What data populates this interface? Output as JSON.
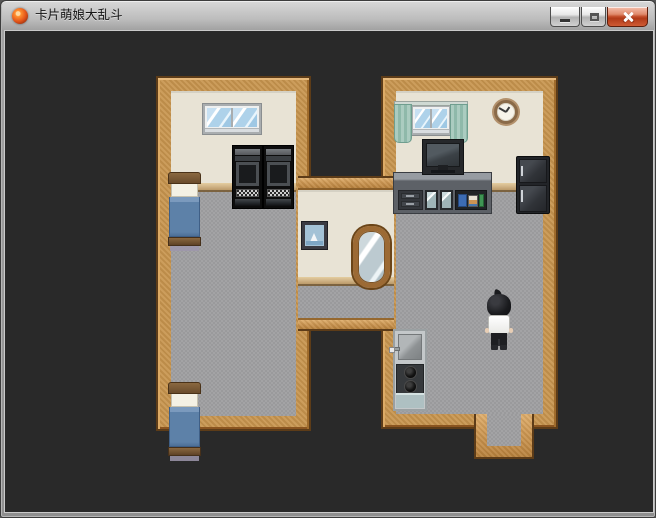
{
  "window": {
    "title": "卡片萌娘大乱斗",
    "icon": "orange-fireball-app-icon",
    "controls": {
      "minimize": "minimize-button",
      "maximize": "maximize-button",
      "close": "close-button"
    }
  },
  "scene": {
    "type": "top-down RPG interior map, H-shaped building on dark backdrop",
    "background_color": "#292929",
    "palette": {
      "wood_wall": "#c8954e",
      "wood_trim": "#5d3c18",
      "interior_wall": "#e8e3d5",
      "baseboard": "#ceb184",
      "floor": "#9e9ea0",
      "bed_blanket": "#5d81a8",
      "curtain": "#9cc2b5",
      "close_button_red": "#c44f2c"
    },
    "rooms": [
      {
        "name": "left-bedroom",
        "furniture": [
          "double-pane-window",
          "black-arcade-machine",
          "black-arcade-machine",
          "blue-bed",
          "blue-bed"
        ]
      },
      {
        "name": "center-hallway",
        "furniture": [
          "framed-sailboat-picture",
          "oval-standing-mirror"
        ]
      },
      {
        "name": "right-living-room",
        "furniture": [
          "curtained-window",
          "wall-clock",
          "tv-on-cabinet",
          "bookshelf-cabinet",
          "refrigerator",
          "sink-and-stove-unit",
          "south-doorway"
        ]
      }
    ],
    "character": {
      "name": "player-character",
      "description": "black-haired figure in white shirt and black pants, seen from behind",
      "location": "right room, standing mid-floor"
    }
  }
}
